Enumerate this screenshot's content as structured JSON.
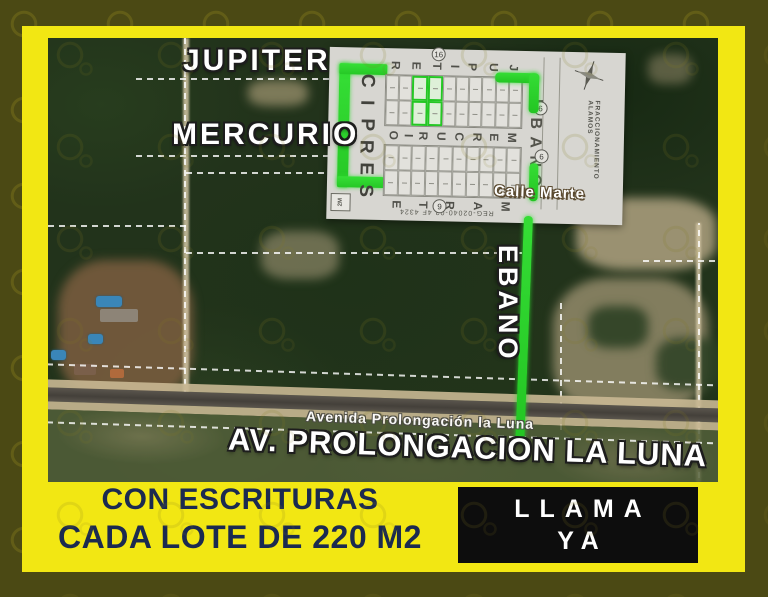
{
  "headline": {
    "line1": "CON ESCRITURAS",
    "line2": "CADA LOTE DE 220 M2"
  },
  "cta": {
    "line1": "LLAMA",
    "line2": "YA"
  },
  "map_labels": {
    "jupiter": "JUPITER",
    "mercurio": "MERCURIO",
    "ebano": "EBANO",
    "avenida_small": "Avenida Prolongación la Luna",
    "avenida_big": "AV. PROLONGACION LA LUNA",
    "calle_marte": "Calle Marte"
  },
  "plat": {
    "cipres": "CIPRES",
    "ebano": "EBANO",
    "streets": [
      {
        "name": "JUPITER",
        "letters": "RETIPUJ"
      },
      {
        "name": "MERCURIO",
        "letters": "OIRUCREM"
      },
      {
        "name": "MARTE",
        "letters": "ETRAM"
      }
    ],
    "fraccionamiento": "FRACCIONAMIENTO ALAMOS",
    "registry": "REG-02040-02 4F 4324",
    "legend": "2M",
    "markers": [
      "16",
      "6",
      "6",
      "9"
    ],
    "blocks": [
      {
        "rows": 2,
        "cols": 10,
        "green_cols": [
          2,
          3
        ]
      },
      {
        "rows": 2,
        "cols": 10,
        "green_cols": []
      }
    ]
  },
  "colors": {
    "frame_yellow": "#F2E713",
    "headline_navy": "#1B2A50",
    "route_green": "#28CF28",
    "cta_black": "#0D0D0D",
    "plat_gray": "#D7D6D1",
    "background_olive": "#4B4914"
  }
}
